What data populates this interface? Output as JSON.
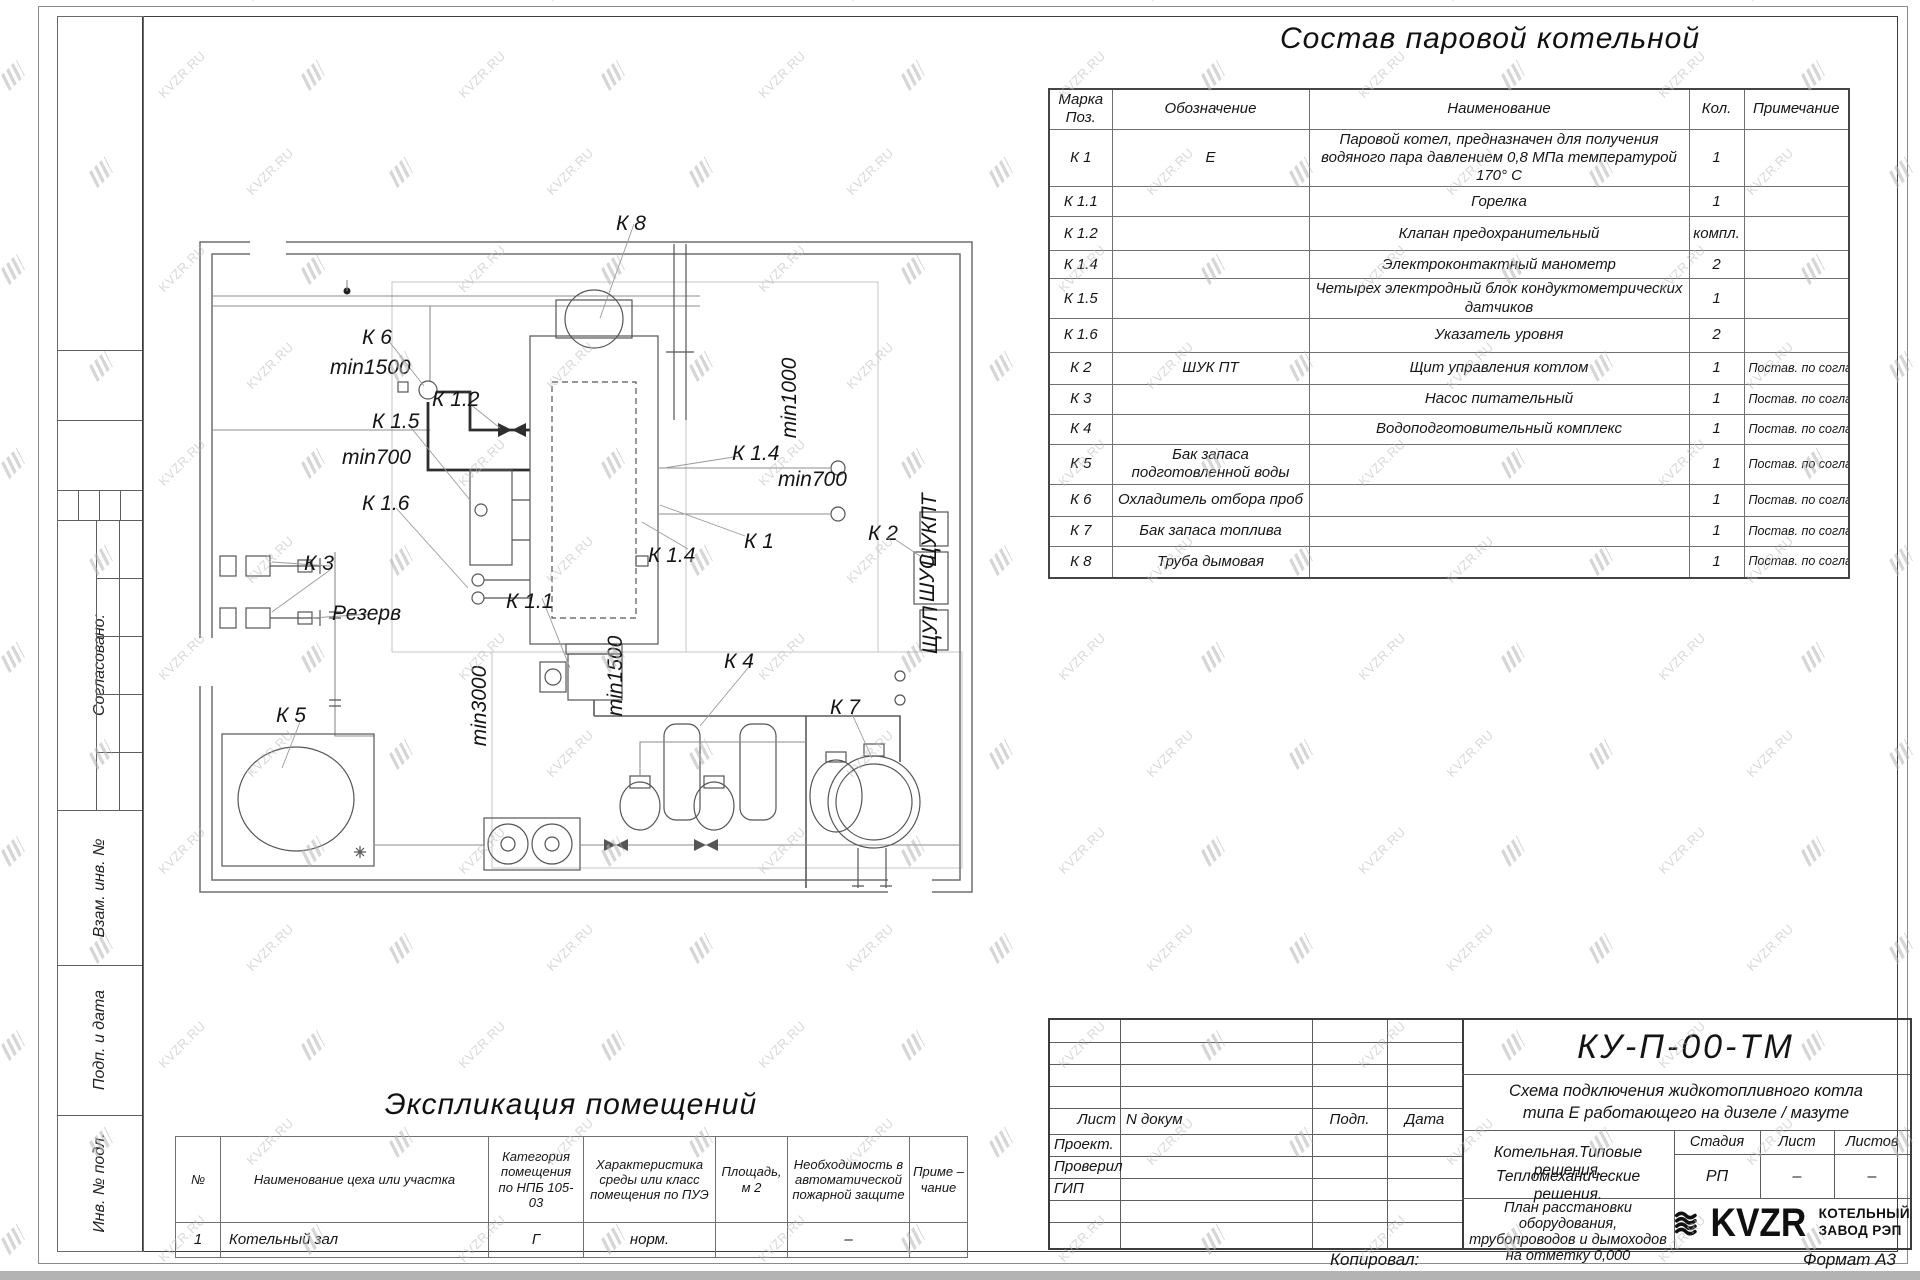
{
  "watermark": {
    "text": "KVZR.RU"
  },
  "drawing_title": "Состав паровой котельной",
  "equipment_table": {
    "headers": {
      "mark": "Марка Поз.",
      "designation": "Обозначение",
      "name": "Наименование",
      "qty": "Кол.",
      "note": "Примечание"
    },
    "rows": [
      {
        "mark": "К 1",
        "designation": "Е",
        "name": "Паровой котел, предназначен для получения водяного пара давлением 0,8 МПа температурой 170° С",
        "qty": "1",
        "note": ""
      },
      {
        "mark": "К 1.1",
        "designation": "",
        "name": "Горелка",
        "qty": "1",
        "note": ""
      },
      {
        "mark": "К 1.2",
        "designation": "",
        "name": "Клапан предохранительный",
        "qty": "компл.",
        "note": ""
      },
      {
        "mark": "К 1.4",
        "designation": "",
        "name": "Электроконтактный манометр",
        "qty": "2",
        "note": ""
      },
      {
        "mark": "К 1.5",
        "designation": "",
        "name": "Четырех электродный блок кондуктометрических датчиков",
        "qty": "1",
        "note": ""
      },
      {
        "mark": "К 1.6",
        "designation": "",
        "name": "Указатель уровня",
        "qty": "2",
        "note": ""
      },
      {
        "mark": "К 2",
        "designation": "ШУК ПТ",
        "name": "Щит управления котлом",
        "qty": "1",
        "note": "Постав. по согласов."
      },
      {
        "mark": "К 3",
        "designation": "",
        "name": "Насос питательный",
        "qty": "1",
        "note": "Постав. по согласов."
      },
      {
        "mark": "К 4",
        "designation": "",
        "name": "Водоподготовительный комплекс",
        "qty": "1",
        "note": "Постав. по согласов."
      },
      {
        "mark": "К 5",
        "designation": "Бак запаса подготовленной воды",
        "name": "",
        "qty": "1",
        "note": "Постав. по согласов."
      },
      {
        "mark": "К 6",
        "designation": "Охладитель отбора проб",
        "name": "",
        "qty": "1",
        "note": "Постав. по согласов."
      },
      {
        "mark": "К 7",
        "designation": "Бак запаса топлива",
        "name": "",
        "qty": "1",
        "note": "Постав. по согласов."
      },
      {
        "mark": "К 8",
        "designation": "Труба дымовая",
        "name": "",
        "qty": "1",
        "note": "Постав. по согласов."
      }
    ]
  },
  "plan": {
    "labels": [
      "К 8",
      "К 6",
      "min1500",
      "К 1.2",
      "К 1.5",
      "min700",
      "К 1.6",
      "min1000",
      "К 1.4",
      "min700",
      "К 1.4",
      "К 1",
      "К 2",
      "К 1.1",
      "К 3",
      "Резерв",
      "min3000",
      "min1500",
      "К 4",
      "К 7",
      "К 5"
    ],
    "panel_labels": [
      "ЩУКПТ",
      "ШУС",
      "ЩУП"
    ]
  },
  "explication": {
    "title": "Экспликация помещений",
    "headers": [
      "№",
      "Наименование цеха или участка",
      "Категория помещения по НПБ 105-03",
      "Характеристика среды или класс помещения по ПУЭ",
      "Площадь, м 2",
      "Необходимость в автоматической пожарной защите",
      "Приме – чание"
    ],
    "rows": [
      [
        "1",
        "Котельный зал",
        "Г",
        "норм.",
        "",
        "–",
        ""
      ]
    ]
  },
  "sidebar": {
    "items": [
      "Согласовано:",
      "Взам. инв. №",
      "Подп. и дата",
      "Инв. № подл."
    ]
  },
  "title_block": {
    "code": "КУ-П-00-ТМ",
    "doc_title_line1": "Схема подключения жидкотопливного котла",
    "doc_title_line2": "типа Е работающего на дизеле / мазуте",
    "header_cells": [
      "Лист",
      "N докум",
      "Подп.",
      "Дата"
    ],
    "roles": [
      "Проект.",
      "Проверил",
      "ГИП"
    ],
    "org_line1": "Котельная.Типовые решения.",
    "org_line2": "Тепломеханические решения.",
    "stage_headers": [
      "Стадия",
      "Лист",
      "Листов"
    ],
    "stage_values": [
      "РП",
      "–",
      "–"
    ],
    "sheet_name": "План расстановки оборудования, трубопроводов и дымоходов на отметку 0,000",
    "logo_text": "KVZR",
    "logo_caption_line1": "КОТЕЛЬНЫЙ",
    "logo_caption_line2": "ЗАВОД РЭП",
    "footer_left": "Копировал:",
    "footer_right": "Формат А3"
  }
}
